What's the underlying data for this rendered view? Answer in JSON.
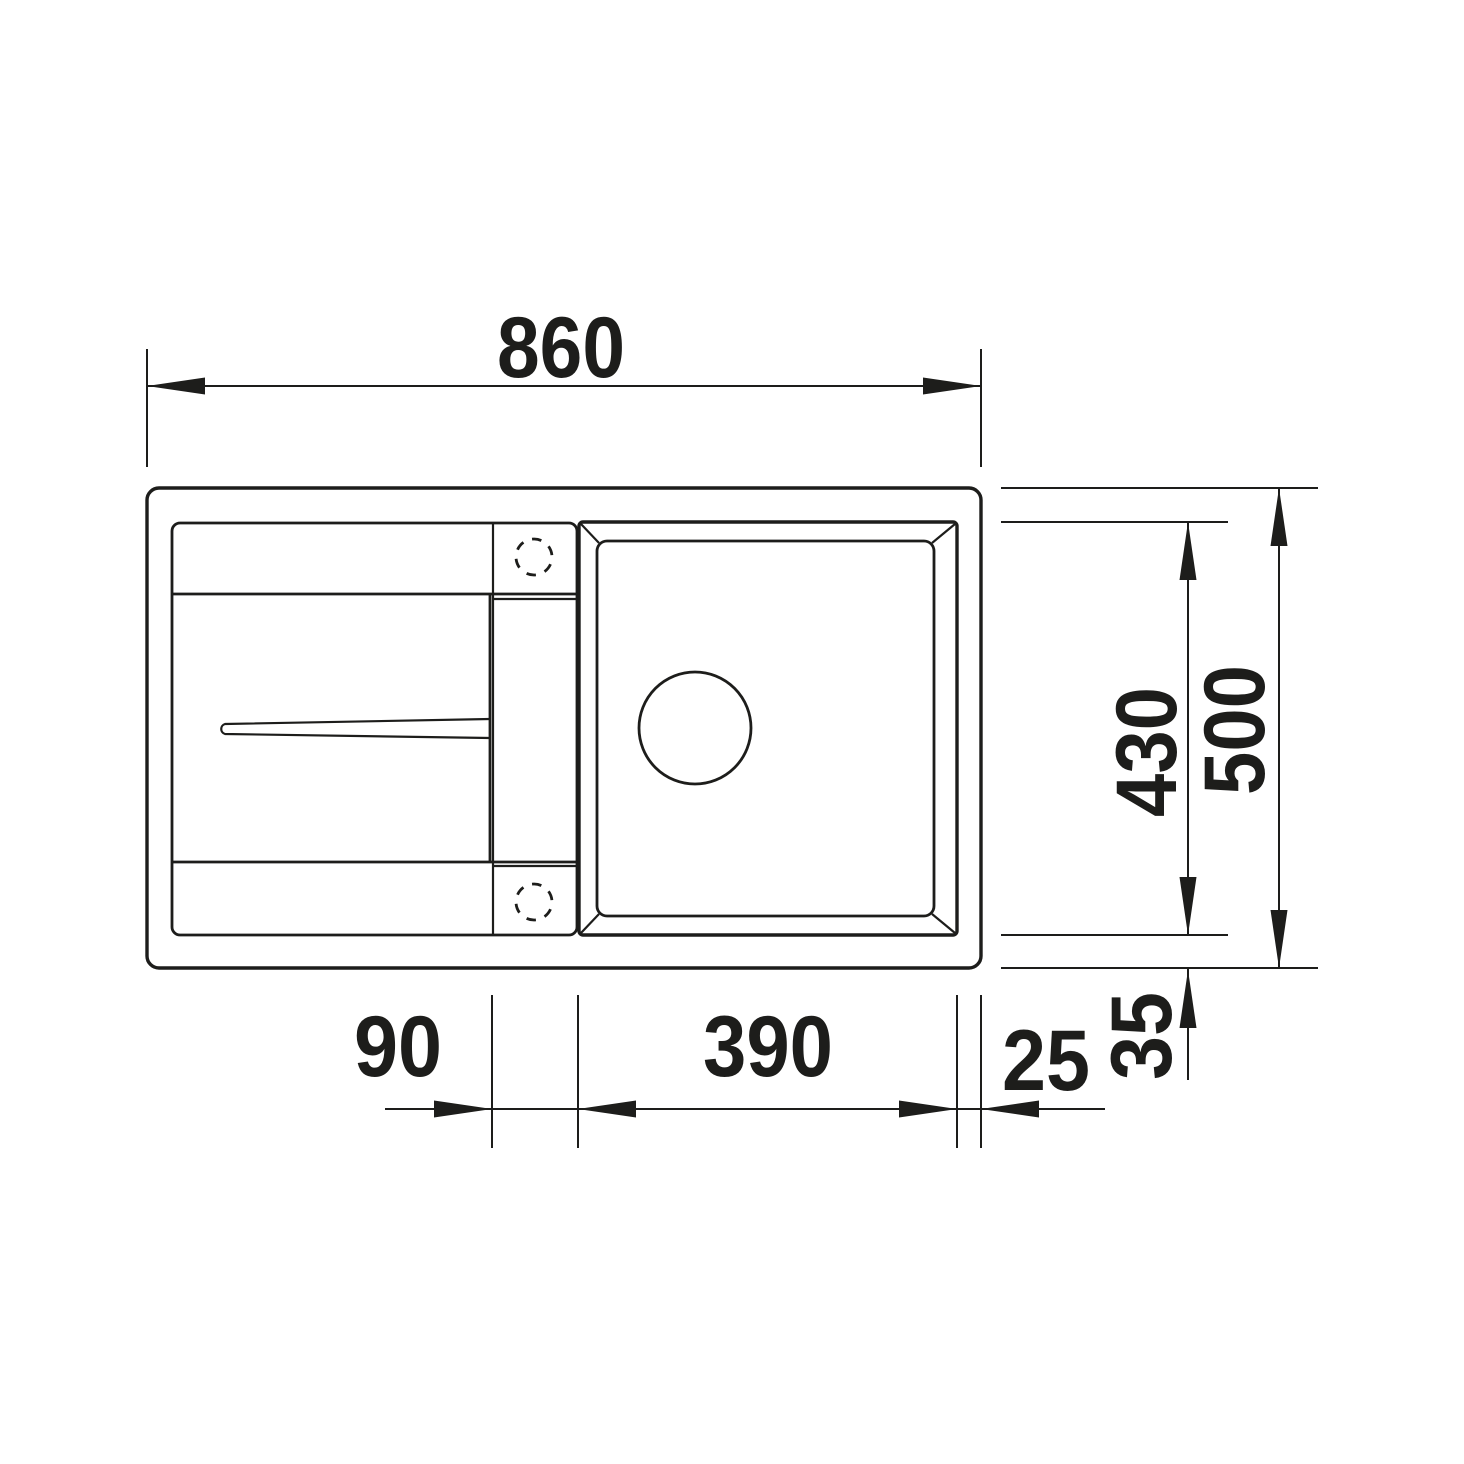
{
  "drawing": {
    "kind": "sink-top-view-dimension-drawing"
  },
  "dimensions": {
    "overall_width": {
      "value": "860"
    },
    "overall_depth": {
      "value": "500"
    },
    "bowl_depth": {
      "value": "430"
    },
    "rim_bottom_offset": {
      "value": "35"
    },
    "faucet_ledge_width": {
      "value": "90"
    },
    "bowl_width": {
      "value": "390"
    },
    "rim_right_offset": {
      "value": "25"
    }
  },
  "colors": {
    "line": "#1d1d1b",
    "background": "#ffffff"
  }
}
